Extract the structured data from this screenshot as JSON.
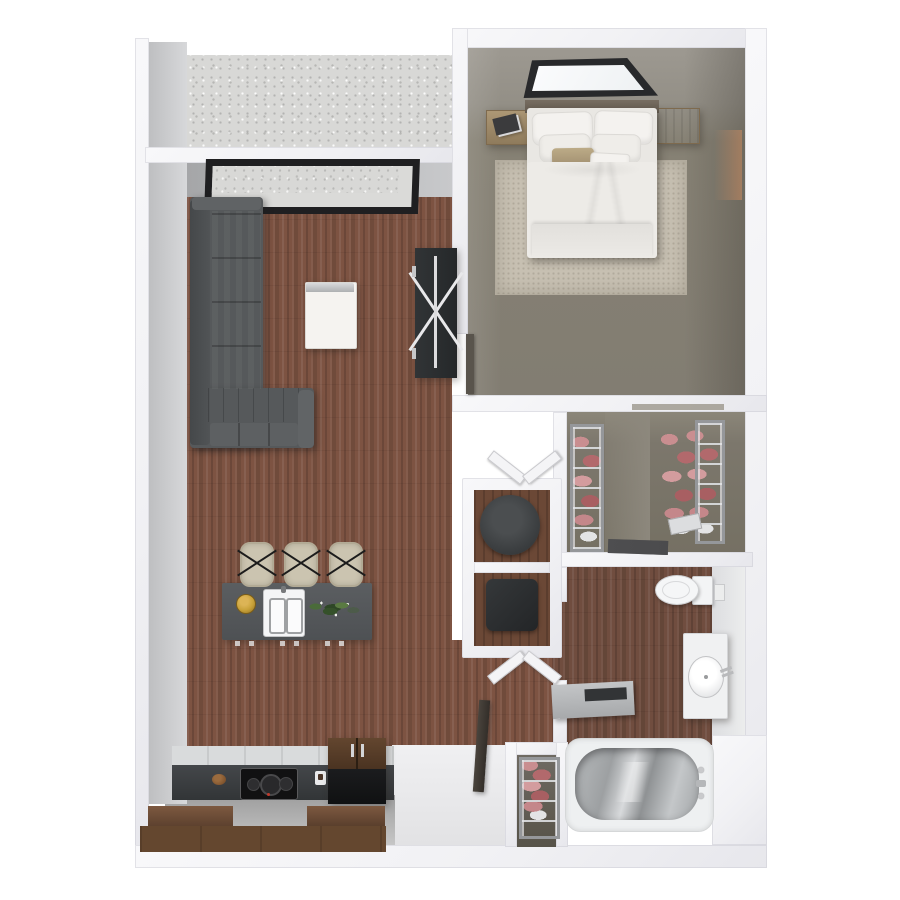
{
  "scene": {
    "kind": "3d-rendered floor plan, top-down view, one-bedroom apartment",
    "background": "#ffffff",
    "rooms": [
      {
        "id": "balcony",
        "label": "balcony",
        "floor": "concrete"
      },
      {
        "id": "living-room",
        "label": "living room",
        "floor": "wood-plank"
      },
      {
        "id": "kitchen",
        "label": "kitchen",
        "floor": "wood-plank"
      },
      {
        "id": "entry",
        "label": "entry",
        "floor": "white-tile"
      },
      {
        "id": "bedroom",
        "label": "bedroom",
        "floor": "olive-gray-carpet"
      },
      {
        "id": "walk-in-closet",
        "label": "walk-in closet",
        "floor": "olive-gray-carpet"
      },
      {
        "id": "laundry-closet",
        "label": "laundry closet",
        "floor": "wood"
      },
      {
        "id": "bathroom",
        "label": "bathroom",
        "floor": "wood-plank"
      }
    ],
    "furniture": {
      "living_room": [
        "l-shaped-sectional-sofa",
        "white-coffee-table",
        "dark-media-console-with-x-base",
        "balcony-window"
      ],
      "kitchen": [
        "island-with-double-sink",
        "gold-plate",
        "herb-plant",
        "bar-stool x3",
        "cooktop-counter",
        "refrigerator",
        "lower-cabinet-bank",
        "wood-bowl",
        "coffee-cup"
      ],
      "bedroom": [
        "double-bed-white-bedding",
        "tan-accent-pillow",
        "nightstand x2",
        "book",
        "area-rug",
        "window",
        "door"
      ],
      "walk_in_closet": [
        "wire-shelving-unit x2",
        "clothes",
        "dresser-top"
      ],
      "laundry_closet": [
        "washer-round-top",
        "dryer-box",
        "bifold-doors x2"
      ],
      "bathroom": [
        "toilet",
        "toilet-paper-holder",
        "vanity-with-oval-sink",
        "bathtub-chrome-interior",
        "wall-shelf-with-tray"
      ],
      "entry": [
        "open-front-door",
        "coat-closet-wire-shelf"
      ]
    },
    "counts": {
      "bar_stools": 3,
      "bed_pillows": 6,
      "wire_shelf_units": 4,
      "nightstands": 2
    },
    "palette": {
      "background": "#ffffff",
      "wall_white": "#f2f2f4",
      "wall_face_gray": "#c0c1c3",
      "wood_floor": "#7d5342",
      "concrete": "#d8d8d6",
      "bedroom_floor": "#868174",
      "closet_floor": "#7c776c",
      "sofa_gray": "#56595b",
      "sofa_shadow": "#434648",
      "island_gray": "#54575a",
      "counter_dark": "#3c3f41",
      "cabinet_wood": "#6b4a36",
      "fridge_black": "#141517",
      "stool_beige": "#cbc4b0",
      "bedding_white": "#edebe7",
      "accent_pillow_tan": "#b1a07d",
      "rug_beige": "#c7c0b2",
      "clothes_pink": "#c4878a",
      "gold_plate": "#c9a23a",
      "plant_green": "#4a6b3a",
      "chrome": "#c9cacc",
      "tub_interior": "#a5a8aa",
      "window_frame": "#28292b",
      "door_dark": "#3f3a35"
    }
  }
}
